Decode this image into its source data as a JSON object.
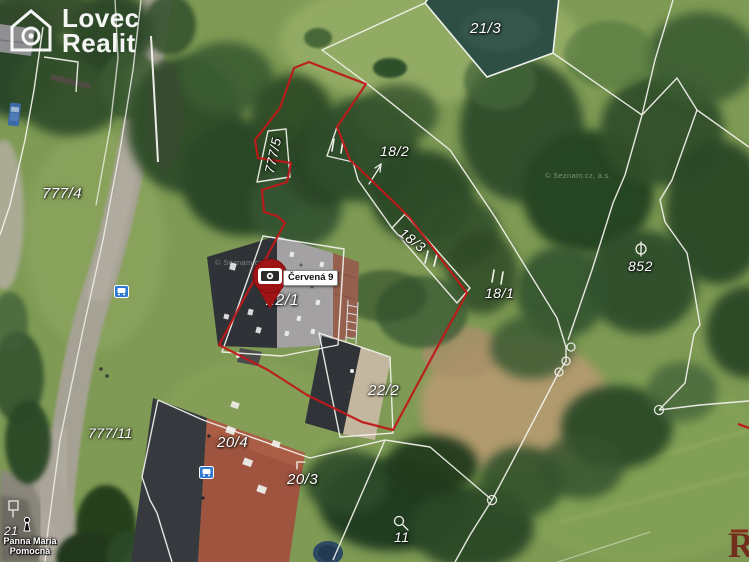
{
  "brand": {
    "line1": "Lovec",
    "line2": "Realit",
    "logo_icon": "house-aperture-icon"
  },
  "marker": {
    "label": "Červená 9",
    "icon": "camera-icon"
  },
  "watermark": {
    "copyright": "© Seznam.cz, a.s.",
    "corner_letter": "R"
  },
  "poi": {
    "church_line1": "Panna Maria",
    "church_line2": "Pomocná",
    "bus_stop_icon": "bus-stop-icon",
    "statue_icon": "statue-icon"
  },
  "map": {
    "parcel_labels": [
      {
        "id": "21/3",
        "text": "21/3"
      },
      {
        "id": "777/4",
        "text": "777/4"
      },
      {
        "id": "777/5",
        "text": "777/5"
      },
      {
        "id": "18/2",
        "text": "18/2"
      },
      {
        "id": "18/3",
        "text": "18/3"
      },
      {
        "id": "18/1",
        "text": "18/1"
      },
      {
        "id": "852",
        "text": "852"
      },
      {
        "id": "22/1",
        "text": "22/1"
      },
      {
        "id": "22/2",
        "text": "22/2"
      },
      {
        "id": "20/4",
        "text": "20/4"
      },
      {
        "id": "777/11",
        "text": "777/11"
      },
      {
        "id": "20/3",
        "text": "20/3"
      },
      {
        "id": "11",
        "text": "11"
      },
      {
        "id": "21",
        "text": "21"
      }
    ],
    "colors": {
      "boundary_red": "#bf1a1a",
      "boundary_white": "#f4f4ee",
      "pin_red": "#9e1315",
      "poi_blue": "#2f78d1",
      "pond": "#2e4f44"
    }
  }
}
